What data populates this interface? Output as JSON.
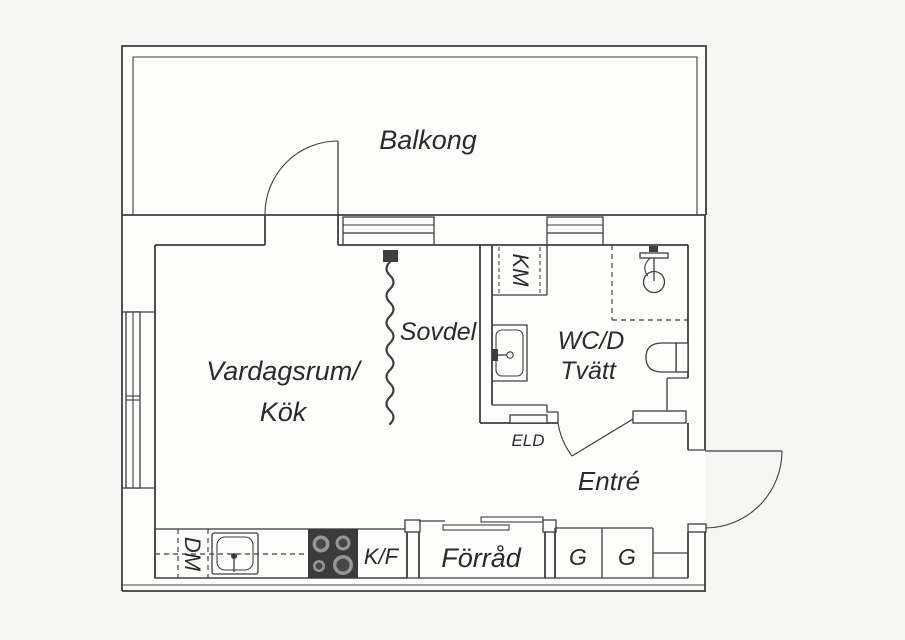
{
  "labels": {
    "balcony": "Balkong",
    "living_line1": "Vardagsrum/",
    "living_line2": "Kök",
    "sleeping": "Sovdel",
    "bathroom_line1": "WC/D",
    "bathroom_line2": "Tvätt",
    "entrance": "Entré",
    "storage": "Förråd",
    "electrical": "ELD",
    "washer": "KM",
    "dishwasher": "DM",
    "fridge_freezer": "K/F",
    "wardrobe_1": "G",
    "wardrobe_2": "G"
  },
  "colors": {
    "line": "#3e3e3e",
    "text": "#2b2b2b",
    "stove": "#3b3b3b",
    "burner_ring": "#969696",
    "burner_center": "#474747",
    "background": "#f6f6f4",
    "floor": "#fdfdfc"
  }
}
